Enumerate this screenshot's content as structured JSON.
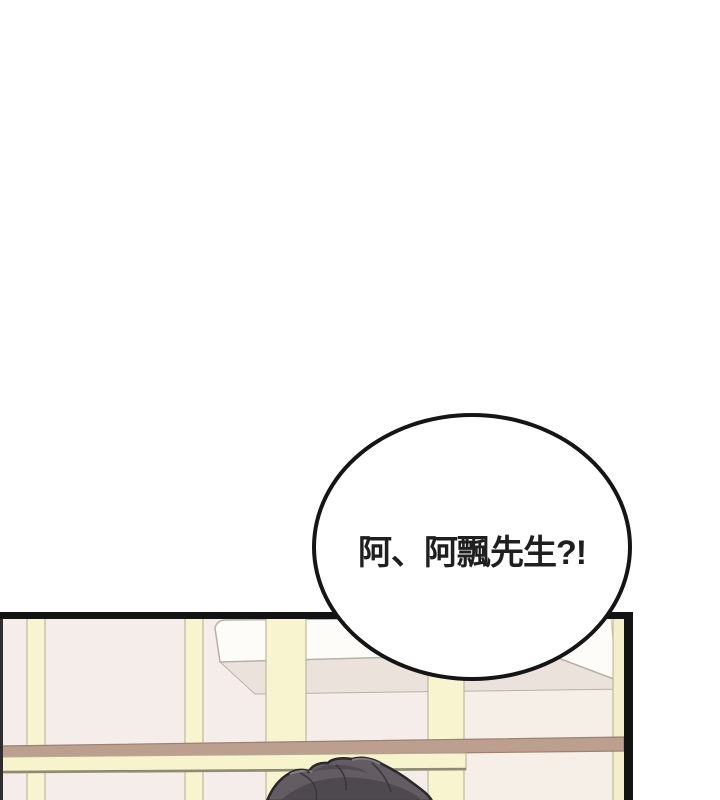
{
  "page": {
    "background_color": "#ffffff",
    "type_label": "comic-panel"
  },
  "speech_bubble": {
    "text": "阿、阿飄先生?!",
    "fill_color": "#ffffff",
    "border_color": "#151515",
    "text_color": "#1f1f1f"
  },
  "scene": {
    "panel_border_color": "#131313",
    "palette": {
      "wall_pink": "#f4ede9",
      "wall_cream": "#f6efe7",
      "frame_cream": "#f7f4cf",
      "frame_outline": "#b3ae92",
      "rail_brown": "#bc9f8f",
      "rail_brown_outline": "#9a8172",
      "rail_bottom_olive": "#8f8a74",
      "shelf_white": "#fdfcf8",
      "shelf_underside": "#ece2dc",
      "shelf_outline": "#b7b1a9",
      "hair_base": "#635d63",
      "hair_dark": "#4a454b",
      "hair_highlight": "#8d858c",
      "hair_outline": "#2b272c"
    }
  }
}
